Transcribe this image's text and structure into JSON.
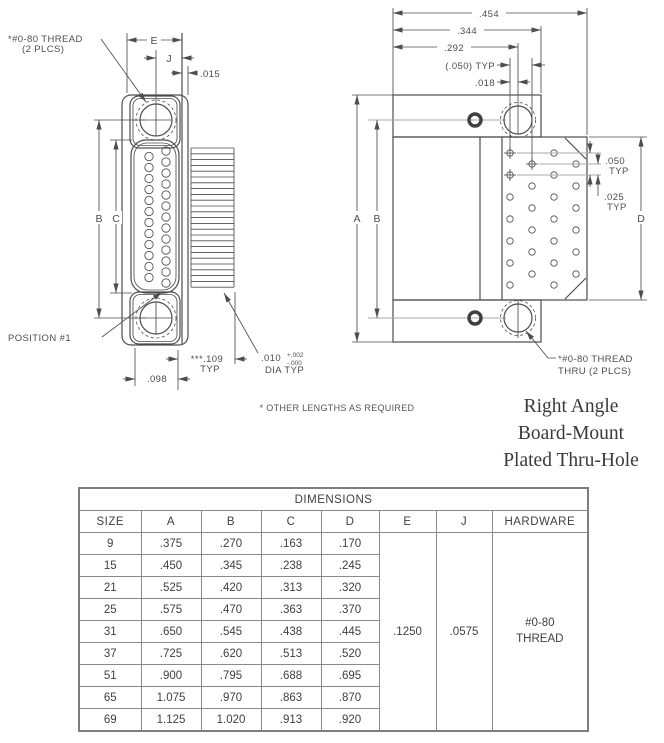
{
  "left_view": {
    "thread_label_line1": "*#0-80 THREAD",
    "thread_label_line2": "(2 PLCS)",
    "dim_e": "E",
    "dim_j": "J",
    "dim_015": ".015",
    "dim_b": "B",
    "dim_c": "C",
    "position_label": "POSITION #1",
    "dim_098": ".098",
    "dim_109": "***.109",
    "dim_109_typ": "TYP",
    "dim_010": ".010",
    "dim_010_tol_plus": "+.002",
    "dim_010_tol_minus": "-.000",
    "dim_010_sub": "DIA  TYP"
  },
  "right_view": {
    "dim_454": ".454",
    "dim_344": ".344",
    "dim_292": ".292",
    "dim_050_paren": "(.050) TYP",
    "dim_018": ".018",
    "dim_a": "A",
    "dim_b": "B",
    "dim_d": "D",
    "dim_050": ".050",
    "dim_050_typ": "TYP",
    "dim_025": ".025",
    "dim_025_typ": "TYP",
    "thread_label_line1": "*#0-80 THREAD",
    "thread_label_line2": "THRU (2 PLCS)"
  },
  "notes": {
    "other_lengths": "* OTHER LENGTHS AS REQUIRED"
  },
  "title": {
    "line1": "Right Angle",
    "line2": "Board-Mount",
    "line3": "Plated Thru-Hole"
  },
  "table": {
    "title": "DIMENSIONS",
    "columns": [
      "SIZE",
      "A",
      "B",
      "C",
      "D",
      "E",
      "J",
      "HARDWARE"
    ],
    "rows": [
      [
        "9",
        ".375",
        ".270",
        ".163",
        ".170"
      ],
      [
        "15",
        ".450",
        ".345",
        ".238",
        ".245"
      ],
      [
        "21",
        ".525",
        ".420",
        ".313",
        ".320"
      ],
      [
        "25",
        ".575",
        ".470",
        ".363",
        ".370"
      ],
      [
        "31",
        ".650",
        ".545",
        ".438",
        ".445"
      ],
      [
        "37",
        ".725",
        ".620",
        ".513",
        ".520"
      ],
      [
        "51",
        ".900",
        ".795",
        ".688",
        ".695"
      ],
      [
        "65",
        "1.075",
        ".970",
        ".863",
        ".870"
      ],
      [
        "69",
        "1.125",
        "1.020",
        ".913",
        ".920"
      ]
    ],
    "merged": {
      "e": ".1250",
      "j": ".0575",
      "hardware": "#0-80\nTHREAD"
    }
  },
  "colors": {
    "line": "#4d4d4d",
    "line_light": "#a9a9a9",
    "table_border": "#7e7e7e",
    "text": "#3f3f3f",
    "title_text": "#3a3a3a",
    "background": "#ffffff"
  }
}
